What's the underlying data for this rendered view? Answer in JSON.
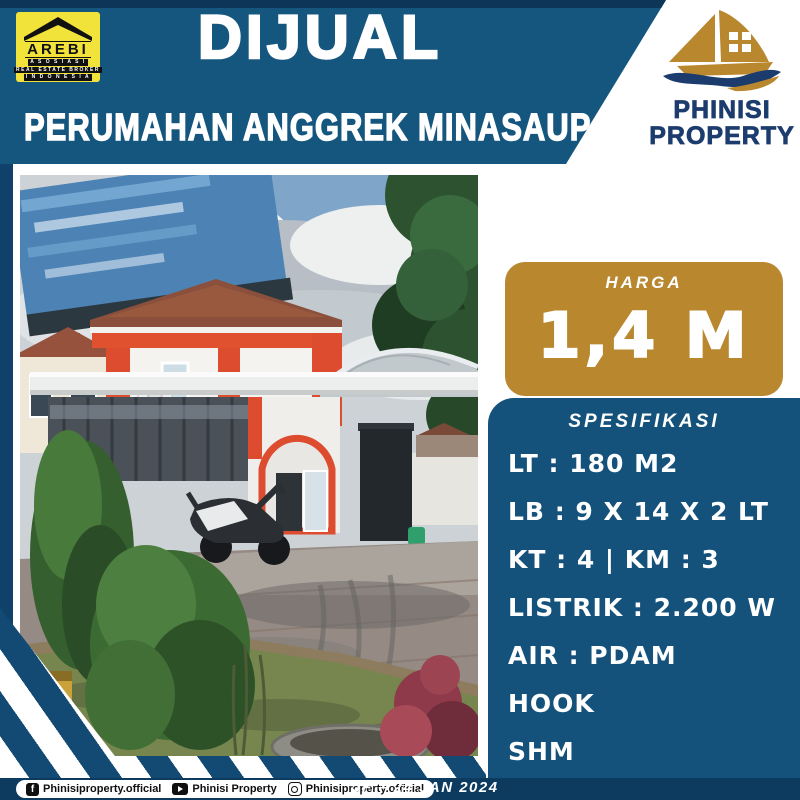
{
  "colors": {
    "main_blue": "#15567f",
    "dark_navy": "#0d3b60",
    "panel_blue": "#14527b",
    "price_gold": "#b8872e",
    "arebi_yellow": "#f2e33a",
    "logo_navy": "#1d3c6e"
  },
  "header": {
    "title": "DIJUAL",
    "subtitle": "PERUMAHAN ANGGREK MINASAUPA"
  },
  "arebi": {
    "name": "AREBI",
    "line1": "A S O S I A S I",
    "line2": "REAL ESTATE BROKER",
    "line3": "I N D O N E S I A"
  },
  "phinisi": {
    "line1": "PHINISI",
    "line2": "PROPERTY"
  },
  "price": {
    "label": "HARGA",
    "value": "1,4 M"
  },
  "spec": {
    "heading": "SPESIFIKASI",
    "items": [
      "LT : 180 M2",
      "LB : 9 X 14 X 2 LT",
      "KT : 4 | KM : 3",
      "LISTRIK : 2.200 W",
      "AIR : PDAM",
      "HOOK",
      "SHM"
    ]
  },
  "footer": {
    "facebook_glyph": "f",
    "facebook": "Phinisiproperty.official",
    "youtube": "Phinisi Property",
    "instagram": "Phinisiproperty.official",
    "date": "JF – 24 JAN 2024"
  }
}
